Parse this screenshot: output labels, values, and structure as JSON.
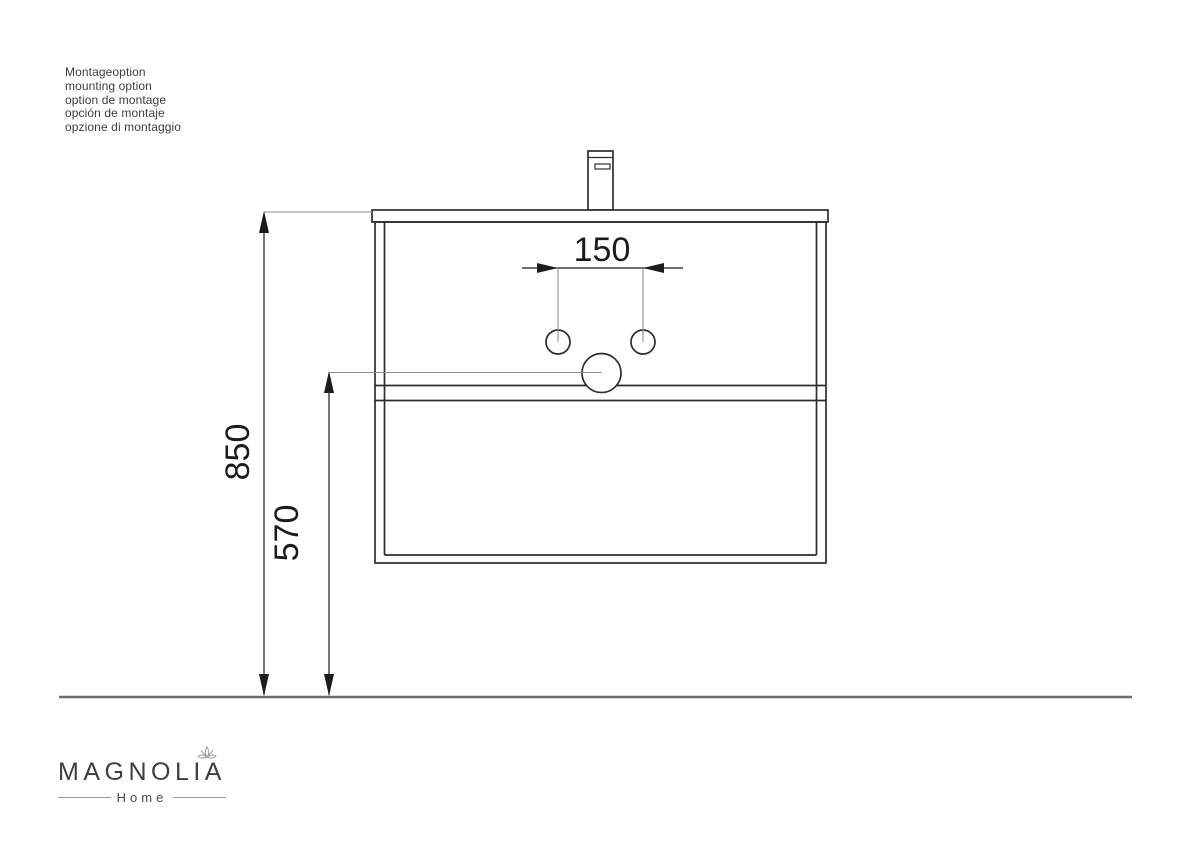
{
  "annotation": {
    "lines": [
      "Montageoption",
      "mounting option",
      "option de montage",
      "opción de montaje",
      "opzione di montaggio"
    ]
  },
  "drawing": {
    "dim_faucet_holes": "150",
    "dim_height_total": "850",
    "dim_height_drain": "570"
  },
  "logo": {
    "brand": "MAGNOLIA",
    "subtitle": "Home"
  },
  "colors": {
    "line_ink": "#2d2d2d",
    "reference_line": "#8f8f8f",
    "floor_line": "#6e6e6e",
    "logo_text": "#3f3f3f"
  }
}
